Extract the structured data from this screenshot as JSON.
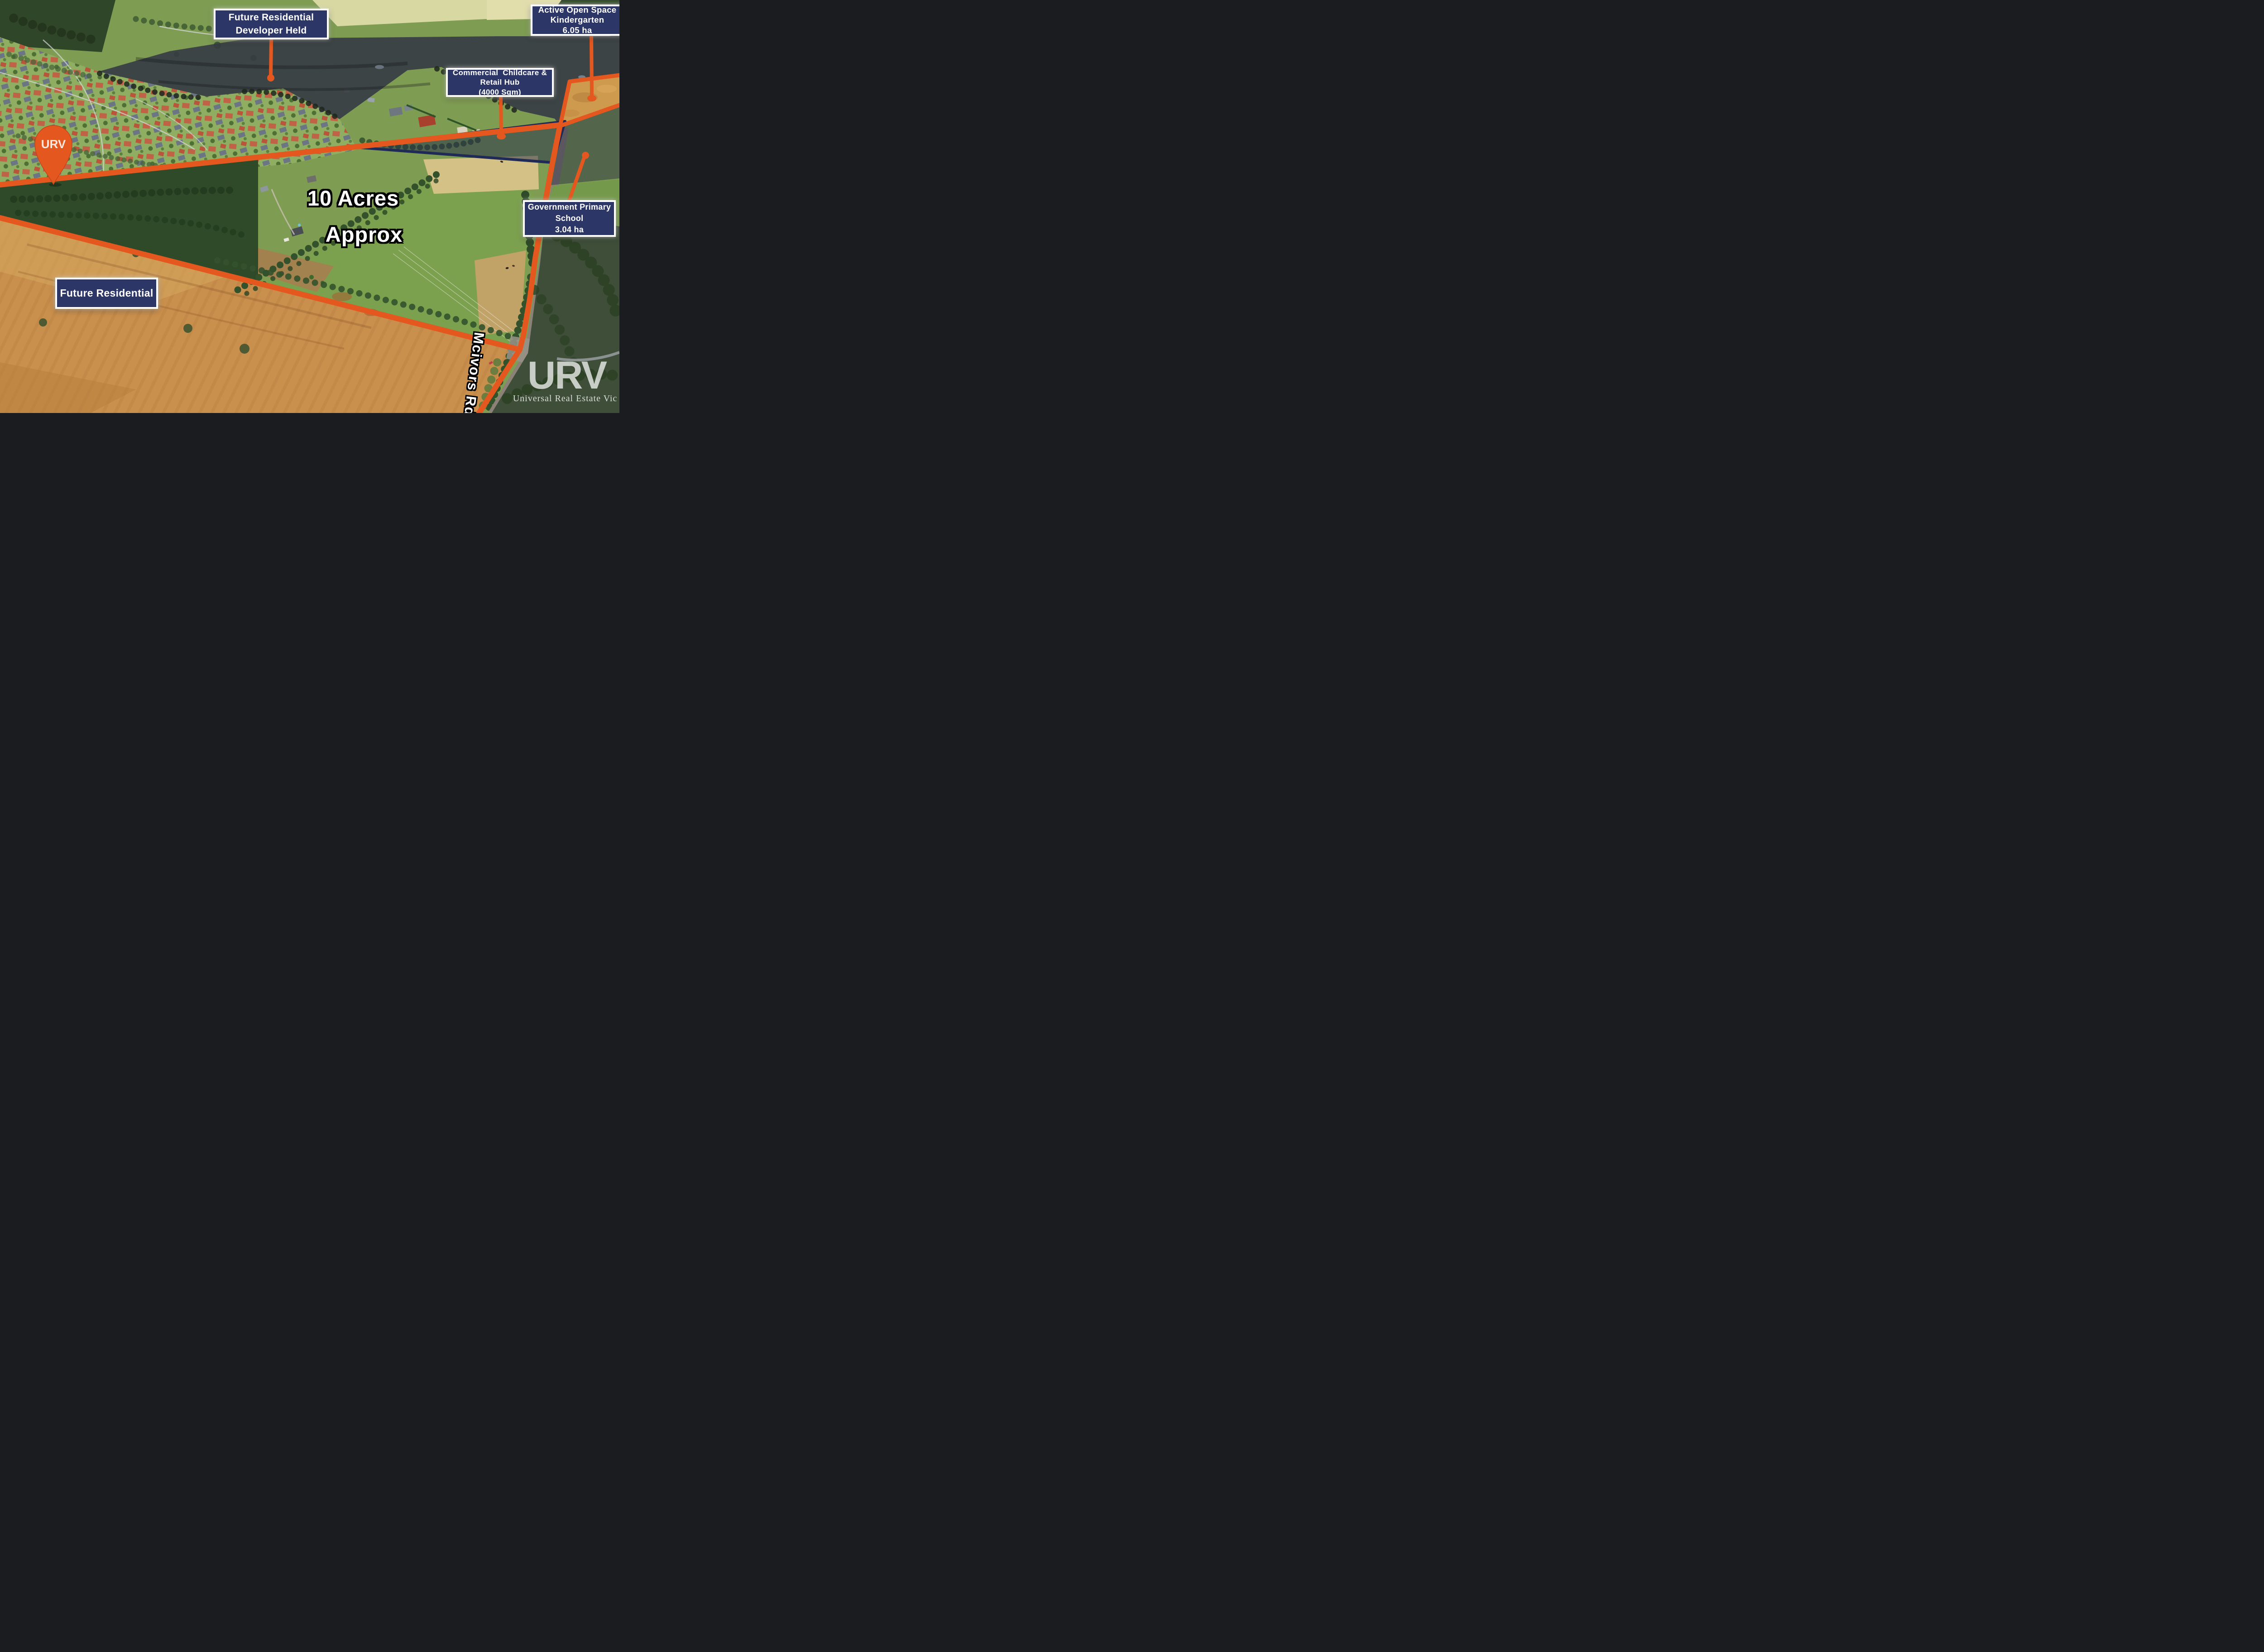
{
  "scene": {
    "description": "Aerial drone photo of 10 acre property with development annotations"
  },
  "labels": {
    "developer_held": {
      "lines": [
        "Future Residential",
        "Developer Held"
      ]
    },
    "active_open_space": {
      "lines": [
        "Active Open Space",
        "Kindergarten",
        "6.05 ha"
      ]
    },
    "commercial_hub": {
      "lines": [
        "Commercial  Childcare &",
        "Retail Hub",
        "(4000 Sqm)"
      ]
    },
    "primary_school": {
      "lines": [
        "Government Primary",
        "School",
        "3.04 ha"
      ]
    },
    "future_residential": {
      "lines": [
        "Future Residential"
      ]
    },
    "acreage": {
      "lines": [
        "10 Acres",
        "Approx"
      ]
    },
    "road_name": "Mcivors Rd"
  },
  "branding": {
    "pin_monogram": "URV",
    "watermark_monogram": "URV",
    "watermark_name": "Universal Real Estate Vic"
  },
  "colors": {
    "accent_orange": "#E4571E",
    "label_navy": "#2C3767",
    "parcel_outline_navy": "#202A56",
    "text_white": "#FFFFFF"
  }
}
